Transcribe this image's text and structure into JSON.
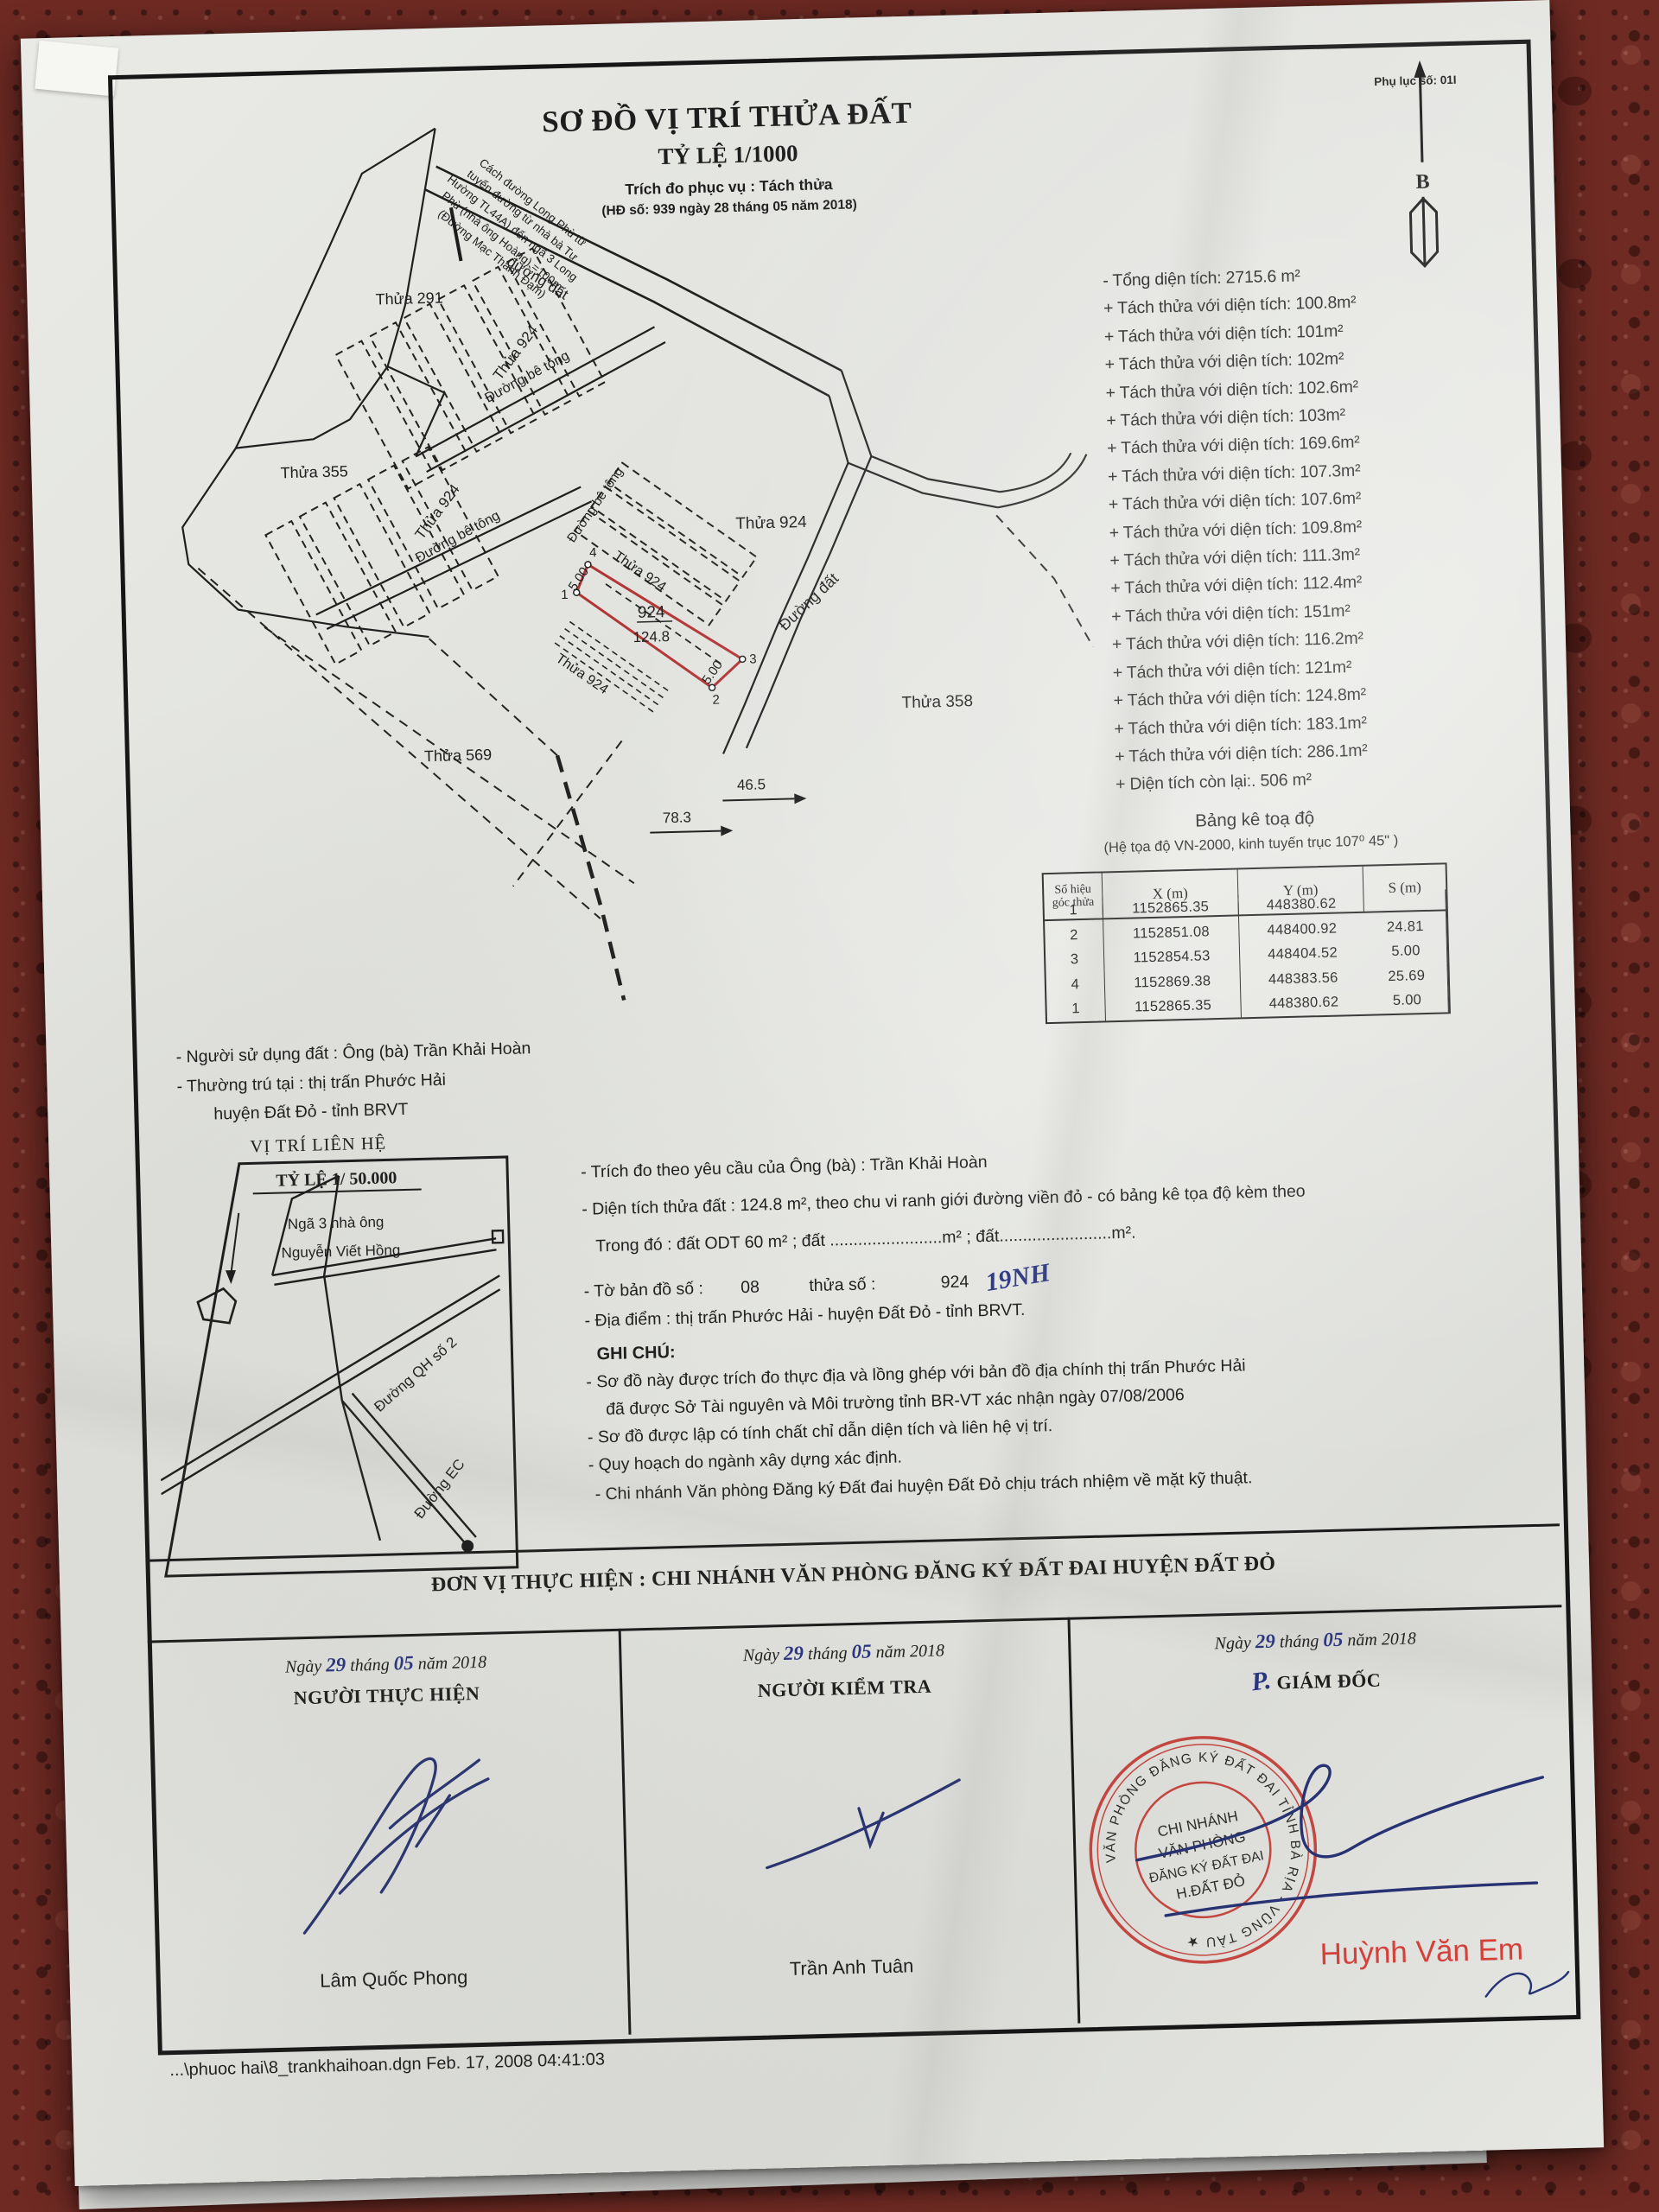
{
  "page": {
    "appendix_note": "Phụ lục số: 01I",
    "file_line": "...\\phuoc hai\\8_trankhaihoan.dgn  Feb. 17, 2008  04:41:03"
  },
  "header": {
    "title": "SƠ ĐỒ VỊ TRÍ THỬA ĐẤT",
    "scale": "TỶ LỆ 1/1000",
    "purpose": "Trích đo phục vụ : Tách thửa",
    "contract": "(HĐ số: 939 ngày 28 tháng 05 năm 2018)",
    "north_label": "B"
  },
  "map": {
    "labels": {
      "thua291": "Thửa 291",
      "thua355": "Thửa 355",
      "thua569": "Thửa 569",
      "thua358": "Thửa 358",
      "thua924": "Thửa 924",
      "road_betong": "Đường bê tông",
      "road_dat_top": "đường đất",
      "road_dat": "Đường đất",
      "parcel_no": "924",
      "parcel_area": "124.8",
      "d500": "5.00",
      "dim465": "46.5",
      "dim783": "78.3",
      "v1": "1",
      "v2": "2",
      "v3": "3",
      "v4": "4"
    },
    "note_lines": [
      "Cách đường Long Phù từ",
      "tuyến đường từ nhà bà Tư",
      "Hường TL44A) đến ngã 3 Long",
      "Phù (nhà ông Hoàng) =100m",
      "(Đường Mạc Thanh Đạm)"
    ]
  },
  "summary": {
    "items": [
      "- Tổng diện tích: 2715.6 m²",
      "+ Tách thửa với diện tích: 100.8m²",
      "+ Tách thửa với diện tích: 101m²",
      "+ Tách thửa với diện tích: 102m²",
      "+ Tách thửa với diện tích: 102.6m²",
      "+ Tách thửa với diện tích: 103m²",
      "+ Tách thửa với diện tích: 169.6m²",
      "+ Tách thửa với diện tích: 107.3m²",
      "+ Tách thửa với diện tích: 107.6m²",
      "+ Tách thửa với diện tích: 109.8m²",
      "+ Tách thửa với diện tích: 111.3m²",
      "+ Tách thửa với diện tích: 112.4m²",
      "+ Tách thửa với diện tích: 151m²",
      "+ Tách thửa với diện tích: 116.2m²",
      "+ Tách thửa với diện tích: 121m²",
      "+ Tách thửa với diện tích: 124.8m²",
      "+ Tách thửa với diện tích: 183.1m²",
      "+ Tách thửa với diện tích: 286.1m²",
      "+ Diện tích còn lại:. 506 m²"
    ]
  },
  "coords": {
    "title": "Bảng kê toạ độ",
    "subtitle": "(Hệ tọa độ VN-2000, kinh tuyến trục 107⁰ 45\" )",
    "headers": [
      "Số hiệu góc thửa",
      "X (m)",
      "Y (m)",
      "S (m)"
    ],
    "rows": [
      [
        "1",
        "1152865.35",
        "448380.62",
        ""
      ],
      [
        "2",
        "1152851.08",
        "448400.92",
        "24.81"
      ],
      [
        "3",
        "1152854.53",
        "448404.52",
        "5.00"
      ],
      [
        "4",
        "1152869.38",
        "448383.56",
        "25.69"
      ],
      [
        "1",
        "1152865.35",
        "448380.62",
        "5.00"
      ]
    ]
  },
  "owner": {
    "line1": "- Người sử dụng đất : Ông (bà) Trần Khải Hoàn",
    "line2": "- Thường trú tại : thị trấn Phước Hải",
    "line3": "huyện Đất Đỏ - tỉnh BRVT"
  },
  "locator": {
    "title": "VỊ TRÍ LIÊN HỆ",
    "scale": "TỶ LỆ 1/ 50.000",
    "note1": "Ngã 3 nhà ông",
    "note2": "Nguyễn Viết Hồng",
    "road_qh": "Đường QH số 2",
    "road_ec": "Đường EC"
  },
  "details": {
    "l1": "- Trích đo theo yêu cầu của Ông (bà) : Trần Khải Hoàn",
    "l2": "- Diện tích thửa đất : 124.8 m², theo chu vi ranh giới đường viền đỏ - có bảng kê tọa độ kèm theo",
    "l3": "Trong đó : đất ODT  60  m² ; đất ........................m² ; đất........................m².",
    "l4_label1": "- Tờ bản đồ số :",
    "l4_value1": "08",
    "l4_label2": "thửa số :",
    "l4_value2": "924",
    "l4_handwritten": "19NH",
    "l5": "- Địa điểm : thị trấn Phước Hải - huyện Đất Đỏ -  tỉnh BRVT."
  },
  "notes": {
    "title": "GHI CHÚ:",
    "n1a": "- Sơ đồ này được trích đo thực địa và lồng ghép với bản đồ địa chính thị trấn Phước Hải",
    "n1b": "đã được Sở Tài nguyên và Môi trường tỉnh BR-VT xác nhận ngày 07/08/2006",
    "n2": "- Sơ đồ được lập có tính chất chỉ dẫn diện tích và liên hệ vị trí.",
    "n3": "- Quy hoạch do ngành xây dựng xác định.",
    "n4": "- Chi nhánh Văn phòng Đăng ký Đất đai huyện Đất Đỏ chịu trách nhiệm về mặt kỹ thuật."
  },
  "signoff": {
    "header": "ĐƠN VỊ THỰC HIỆN : CHI NHÁNH VĂN PHÒNG ĐĂNG KÝ ĐẤT ĐAI HUYỆN ĐẤT ĐỎ",
    "date": {
      "ngay": "Ngày",
      "day": "29",
      "thang": "tháng",
      "month": "05",
      "nam": "năm 2018"
    },
    "col1_role": "NGƯỜI THỰC HIỆN",
    "col2_role": "NGƯỜI KIỂM TRA",
    "col3_prefix": "P.",
    "col3_role": "GIÁM ĐỐC",
    "col1_name": "Lâm Quốc Phong",
    "col2_name": "Trần Anh Tuân",
    "col3_name": "Huỳnh Văn Em"
  },
  "stamp": {
    "ring": "VĂN PHÒNG ĐĂNG KÝ ĐẤT ĐAI TỈNH BÀ RỊA - VŨNG TÀU ★",
    "center1": "CHI NHÁNH",
    "center2": "VĂN PHÒNG",
    "center3": "ĐĂNG KÝ ĐẤT ĐAI",
    "center4": "H.ĐẤT ĐỎ"
  },
  "colors": {
    "stamp_red": "#c23a33",
    "name_red": "#d4403a",
    "ink_blue": "#2a3580",
    "parcel_red": "#b23535"
  }
}
